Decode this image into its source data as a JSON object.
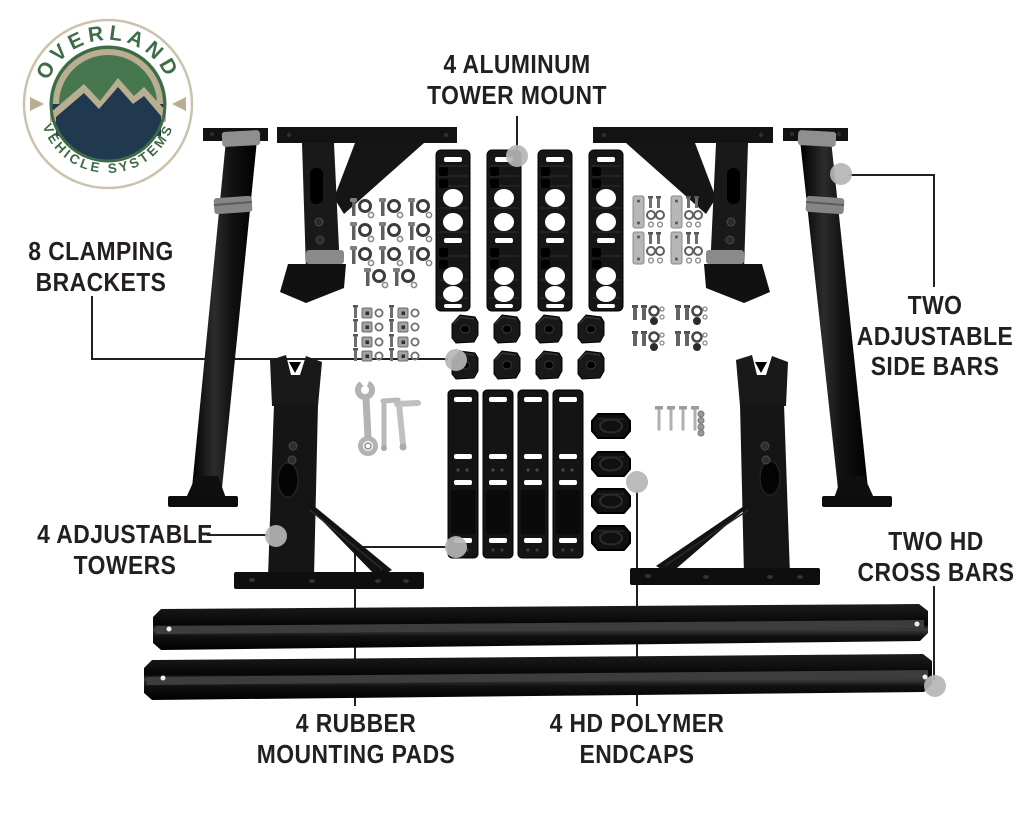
{
  "page": {
    "width": 1024,
    "height": 819,
    "background": "#ffffff",
    "type": "product parts diagram"
  },
  "logo": {
    "name": "Overland Vehicle Systems badge",
    "text_top": "OVERLAND",
    "text_bottom": "VEHICLE SYSTEMS",
    "colors": {
      "green": "#3e6c47",
      "navy": "#20394e",
      "tan": "#b9ae92",
      "ring_border": "#cbc3ab",
      "white": "#ffffff"
    }
  },
  "style": {
    "label_color": "#231f20",
    "leader_line_color": "#231f20",
    "leader_dot_color": "#b5b5b5"
  },
  "callouts": [
    {
      "id": "tower-mount",
      "lines": [
        "4 ALUMINUM",
        "TOWER MOUNT"
      ],
      "text": {
        "x": 517,
        "y": 49
      },
      "leader": [
        [
          517,
          116
        ],
        [
          517,
          149
        ]
      ],
      "dot": [
        517,
        156
      ]
    },
    {
      "id": "clamping-brackets",
      "lines": [
        "8 CLAMPING",
        "BRACKETS"
      ],
      "text": {
        "x": 101,
        "y": 236
      },
      "leader": [
        [
          92,
          296
        ],
        [
          92,
          359
        ],
        [
          448,
          359
        ]
      ],
      "dot": [
        456,
        360
      ]
    },
    {
      "id": "side-bars",
      "lines": [
        "TWO",
        "ADJUSTABLE",
        "SIDE BARS"
      ],
      "text": {
        "x": 935,
        "y": 290
      },
      "leader": [
        [
          934,
          287
        ],
        [
          934,
          175
        ],
        [
          849,
          175
        ]
      ],
      "dot": [
        841,
        174
      ]
    },
    {
      "id": "adjustable-towers",
      "lines": [
        "4 ADJUSTABLE",
        "TOWERS"
      ],
      "text": {
        "x": 125,
        "y": 519
      },
      "leader": [
        [
          207,
          535
        ],
        [
          268,
          535
        ]
      ],
      "dot": [
        276,
        536
      ]
    },
    {
      "id": "cross-bars",
      "lines": [
        "TWO HD",
        "CROSS BARS"
      ],
      "text": {
        "x": 936,
        "y": 526
      },
      "leader": [
        [
          934,
          586
        ],
        [
          934,
          680
        ]
      ],
      "dot": [
        935,
        686
      ]
    },
    {
      "id": "mounting-pads",
      "lines": [
        "4 RUBBER",
        "MOUNTING PADS"
      ],
      "text": {
        "x": 356,
        "y": 708
      },
      "leader": [
        [
          355,
          706
        ],
        [
          355,
          547
        ],
        [
          450,
          547
        ]
      ],
      "dot": [
        456,
        547
      ]
    },
    {
      "id": "endcaps",
      "lines": [
        "4 HD POLYMER",
        "ENDCAPS"
      ],
      "text": {
        "x": 637,
        "y": 708
      },
      "leader": [
        [
          637,
          706
        ],
        [
          637,
          490
        ]
      ],
      "dot": [
        637,
        482
      ]
    }
  ]
}
